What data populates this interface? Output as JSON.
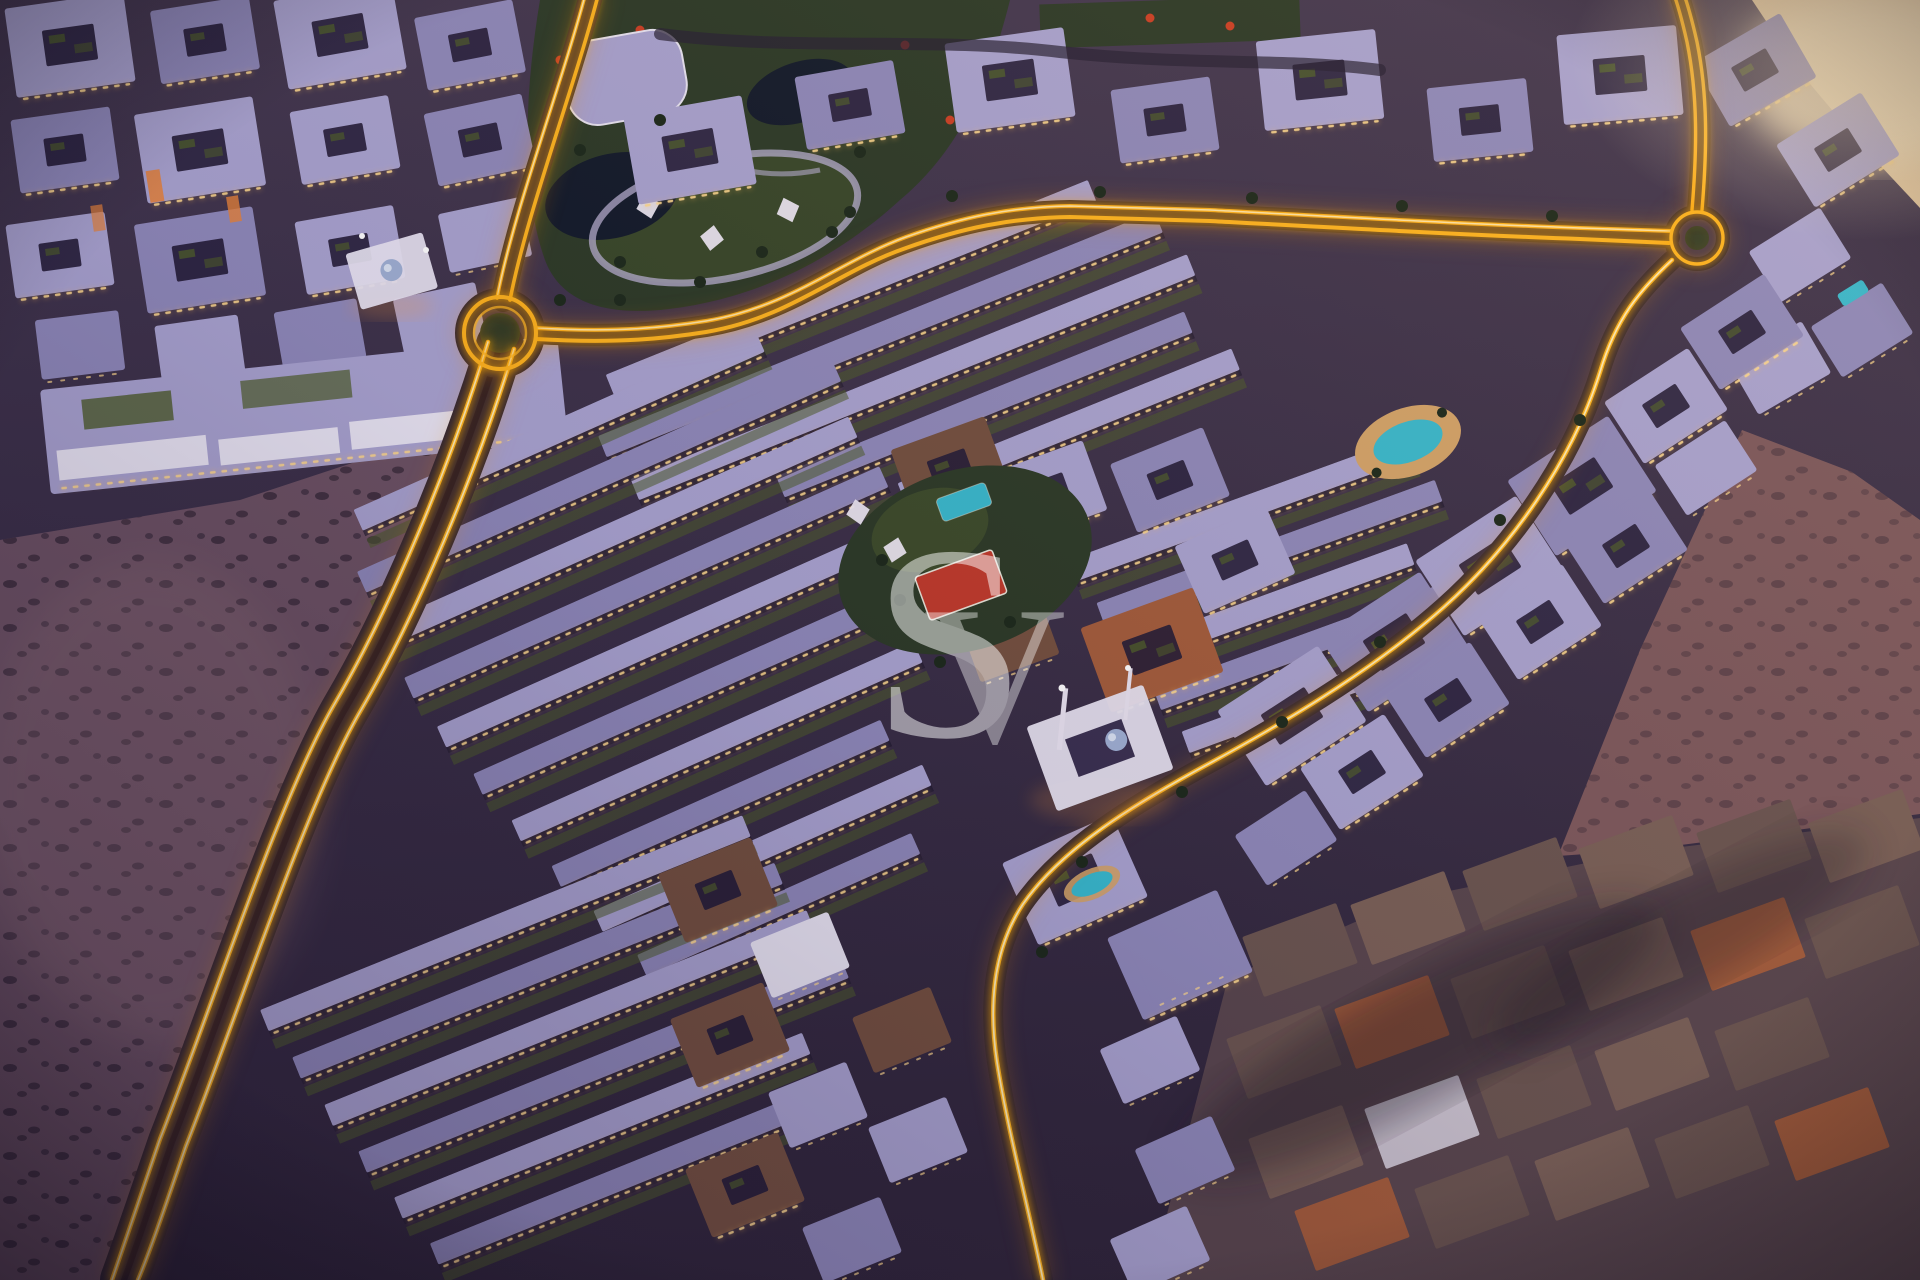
{
  "image": {
    "kind": "aerial-masterplan-dusk-render"
  },
  "watermark": {
    "s": "S",
    "v": "V",
    "color": "#ffffff",
    "opacity": 0.5
  },
  "palette": {
    "ground": "#43374f",
    "groundMid": "#392e46",
    "groundDeep": "#2f2539",
    "devZone": "#2a2238",
    "desertLeft": "#6d5263",
    "desertRight": "#7d585c",
    "sandBright": "#eccfa4",
    "roofA": "#a9a3d0",
    "roofB": "#8f89ba",
    "white": "#e9e5f3",
    "terracotta": "#a35c3b",
    "walkup": "#74503f",
    "facadeShadow": "#1f1930",
    "windowWarm": "#ffd98e",
    "glowAmber": "#ffb41e",
    "glowCore": "#fff3c4",
    "asphalt": "#262033",
    "parkGreen": "#2c3a27",
    "parkLawn": "#4c5c2e",
    "pond": "#121a2a",
    "pathLight": "#b9b1d4",
    "garden": "#4e5c2a",
    "tree": "#1c291b",
    "canopy": "#efeaf6",
    "pool": "#38b9cd",
    "poolDeck": "#d3a368",
    "courtRed": "#c03a2b",
    "cityBase": "#59464d",
    "cityRoof": "#6b5550",
    "cityRoofAlt": "#7a6057",
    "orangeAccent": "#e8833a",
    "mosqueGlow": "#ff9d3a",
    "domeBlue": "#9fb0d4",
    "redTree": "#cc3f24"
  }
}
